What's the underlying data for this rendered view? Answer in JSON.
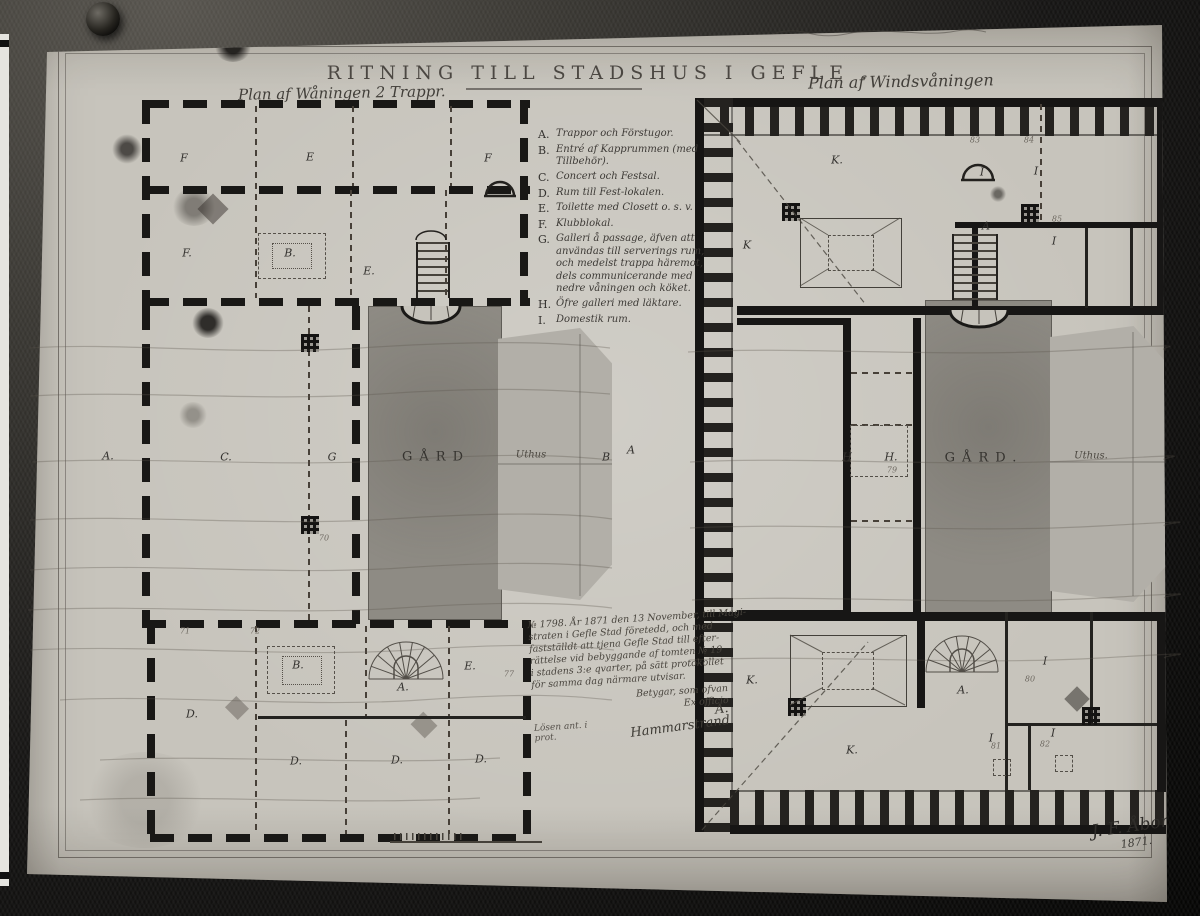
{
  "photo": {
    "archive_label": "K.B.B.",
    "title": "RITNING TILL STADSHUS I GEFLE .",
    "signature_name": "J. F. Åbom",
    "signature_year": "1871."
  },
  "plans": {
    "left_label": "Plan af Wåningen 2 Trappr.",
    "right_label": "Plan af Windsvåningen",
    "left_court": "GÅRD",
    "right_court": "GÅRD.",
    "left_uthus": "Uthus",
    "right_uthus": "Uthus."
  },
  "legend": {
    "items": [
      {
        "key": "A.",
        "text": "Trappor och Förstugor."
      },
      {
        "key": "B.",
        "text": "Entré af Kapprummen (med Tillbehör)."
      },
      {
        "key": "C.",
        "text": "Concert och Festsal."
      },
      {
        "key": "D.",
        "text": "Rum till Fest-lokalen."
      },
      {
        "key": "E.",
        "text": "Toilette med Closett o. s. v."
      },
      {
        "key": "F.",
        "text": "Klubblokal."
      },
      {
        "key": "G.",
        "text": "Galleri å passage, äfven att användas till serverings rum, och medelst trappa häremot, dels communicerande med nedre våningen och köket."
      },
      {
        "key": "H.",
        "text": "Öfre galleri med läktare."
      },
      {
        "key": "I.",
        "text": "Domestik rum."
      }
    ]
  },
  "note": {
    "lines": [
      "№ 1798. År 1871 den 13 November, till Magi-",
      "straten i Gefle Stad företedd, och med",
      "fastställdt att tjena Gefle Stad till efter-",
      "rättelse vid bebyggande af tomten № 19",
      "i stadens 3:e qvarter, på sätt protokollet",
      "för samma dag närmare utvisar."
    ],
    "closing_pre": "Betygar, som ofvan",
    "closing": "Ex officio",
    "closing_signature": "A. Hammarstrand",
    "side_note": "Lösen ant. i prot."
  },
  "room_letters": [
    {
      "t": "F",
      "x": 184,
      "y": 158
    },
    {
      "t": "E",
      "x": 310,
      "y": 157
    },
    {
      "t": "F",
      "x": 488,
      "y": 158
    },
    {
      "t": "F.",
      "x": 187,
      "y": 253
    },
    {
      "t": "B.",
      "x": 290,
      "y": 253
    },
    {
      "t": "E.",
      "x": 369,
      "y": 271
    },
    {
      "t": "C.",
      "x": 226,
      "y": 457
    },
    {
      "t": "G",
      "x": 332,
      "y": 457
    },
    {
      "t": "A.",
      "x": 108,
      "y": 456
    },
    {
      "t": "B",
      "x": 606,
      "y": 457
    },
    {
      "t": "A",
      "x": 631,
      "y": 450
    },
    {
      "t": "D.",
      "x": 192,
      "y": 714
    },
    {
      "t": "B.",
      "x": 298,
      "y": 665
    },
    {
      "t": "A.",
      "x": 403,
      "y": 687
    },
    {
      "t": "E.",
      "x": 470,
      "y": 666
    },
    {
      "t": "D.",
      "x": 296,
      "y": 761
    },
    {
      "t": "D.",
      "x": 397,
      "y": 760
    },
    {
      "t": "D.",
      "x": 481,
      "y": 759
    },
    {
      "t": "K.",
      "x": 837,
      "y": 160
    },
    {
      "t": "I",
      "x": 982,
      "y": 172
    },
    {
      "t": "I",
      "x": 1036,
      "y": 171
    },
    {
      "t": "A",
      "x": 986,
      "y": 226
    },
    {
      "t": "K",
      "x": 747,
      "y": 245
    },
    {
      "t": "I",
      "x": 1054,
      "y": 241
    },
    {
      "t": "H",
      "x": 847,
      "y": 457
    },
    {
      "t": "H.",
      "x": 891,
      "y": 457
    },
    {
      "t": "K.",
      "x": 752,
      "y": 680
    },
    {
      "t": "K.",
      "x": 852,
      "y": 750
    },
    {
      "t": "A.",
      "x": 963,
      "y": 690
    },
    {
      "t": "I",
      "x": 1045,
      "y": 661
    },
    {
      "t": "I",
      "x": 991,
      "y": 738
    },
    {
      "t": "I",
      "x": 1053,
      "y": 733
    }
  ],
  "room_numbers": [
    {
      "t": "70",
      "x": 324,
      "y": 538
    },
    {
      "t": "71",
      "x": 185,
      "y": 631
    },
    {
      "t": "72",
      "x": 255,
      "y": 631
    },
    {
      "t": "77",
      "x": 509,
      "y": 674
    },
    {
      "t": "79",
      "x": 892,
      "y": 470
    },
    {
      "t": "80",
      "x": 1030,
      "y": 679
    },
    {
      "t": "81",
      "x": 996,
      "y": 746
    },
    {
      "t": "82",
      "x": 1045,
      "y": 744
    },
    {
      "t": "83",
      "x": 975,
      "y": 140
    },
    {
      "t": "84",
      "x": 1029,
      "y": 140
    },
    {
      "t": "85",
      "x": 1057,
      "y": 219
    }
  ]
}
